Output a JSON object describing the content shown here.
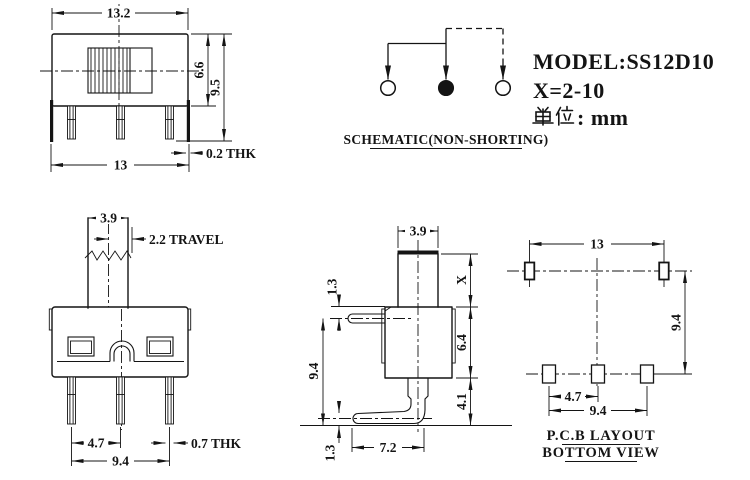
{
  "info": {
    "model": "MODEL:SS12D10",
    "x_range": "X=2-10",
    "unit_full": "单位：mm",
    "unit_display": ": mm"
  },
  "schematic": {
    "caption": "SCHEMATIC(NON-SHORTING)"
  },
  "front_view": {
    "dim_width_top": "13.2",
    "dim_body_height": "6.6",
    "dim_total_height": "9.5",
    "dim_tab_thk": "0.2 THK",
    "dim_width_bottom": "13"
  },
  "travel_view": {
    "dim_knob_width": "3.9",
    "dim_travel": "2.2 TRAVEL",
    "dim_pin_pitch": "4.7",
    "dim_pin_thk": "0.7 THK",
    "dim_pin_span": "9.4"
  },
  "side_view": {
    "dim_knob_width": "3.9",
    "dim_lug_offset": "1.3",
    "dim_knob_height": "X",
    "dim_body_height": "6.4",
    "dim_pin_drop": "4.1",
    "dim_overall": "9.4",
    "dim_pin_base": "1.3",
    "dim_pin_reach": "7.2"
  },
  "pcb_view": {
    "dim_tab_span": "13",
    "dim_row_gap": "9.4",
    "dim_pin_pitch": "4.7",
    "dim_pin_span": "9.4",
    "caption_line1": "P.C.B LAYOUT",
    "caption_line2": "BOTTOM VIEW"
  }
}
